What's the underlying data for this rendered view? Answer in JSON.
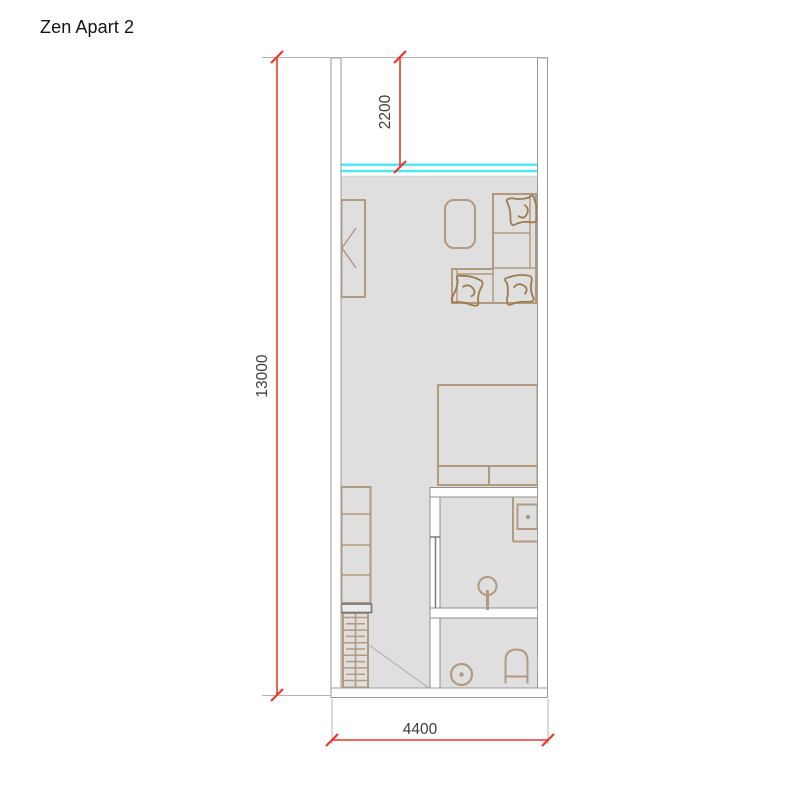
{
  "title": "Zen Apart 2",
  "plan": {
    "dimensions": {
      "total_height": "13000",
      "balcony_depth": "2200",
      "total_width": "4400"
    },
    "colors": {
      "dimension_red": "#ee372b",
      "extension_gray": "#b3b3b3",
      "floor_gray": "#dfdfdf",
      "wall_outline_gray": "#909090",
      "furniture_tan": "#b49a7c",
      "sofa_brown": "#9d7b4d",
      "window_cyan": "#4be8f5",
      "label_text": "#3e3e3e"
    },
    "rooms": [
      "balcony",
      "living-area",
      "shower-room",
      "toilet-room"
    ],
    "furniture": [
      "wardrobe",
      "coffee-table",
      "corner-sofa",
      "bed",
      "kitchen-cabinets",
      "stairs",
      "washbasin-cabinet",
      "shower",
      "washing-machine",
      "toilet"
    ]
  }
}
